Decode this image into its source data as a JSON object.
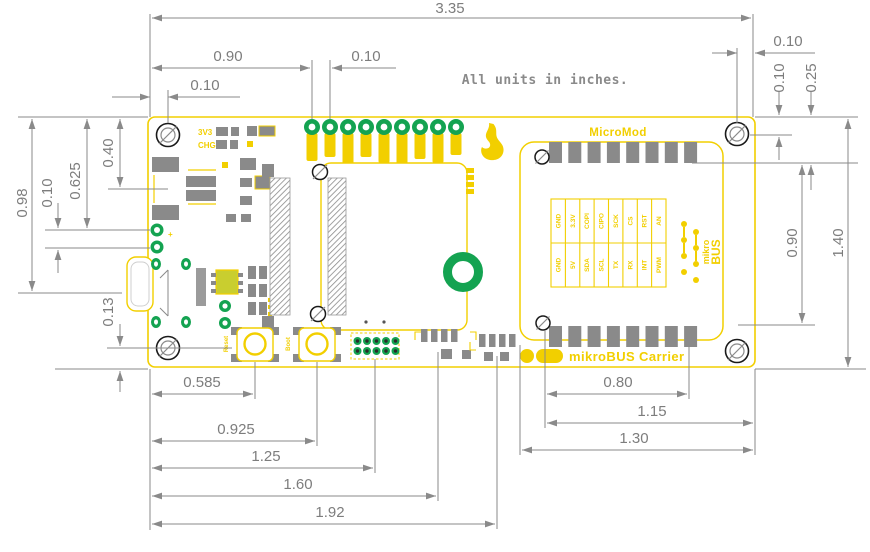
{
  "note": "All units in inches.",
  "silkscreen": {
    "micromod": "MicroMod",
    "carrier": "mikroBUS Carrier",
    "led_3v3": "3V3",
    "led_chg": "CHG",
    "btn_reset": "Reset",
    "btn_boot": "Boot",
    "logo_mikro": "mikro",
    "logo_bus": "BUS",
    "battery_plus": "+",
    "pin_top": [
      "GND",
      "3.3V",
      "COPI",
      "CIPO",
      "SCK",
      "CS",
      "RST",
      "AN"
    ],
    "pin_bottom": [
      "GND",
      "5V",
      "SDA",
      "SCL",
      "TX",
      "RX",
      "INT",
      "PWM"
    ]
  },
  "dimensions": {
    "board_width": "3.35",
    "header_offset_x": "0.90",
    "header_pitch": "0.10",
    "hole_tl_x": "0.10",
    "hole_tr_x": "0.10",
    "hole_tr_y": "0.10",
    "pads_top_y": "0.25",
    "socket_height": "0.90",
    "board_height": "1.40",
    "left_098": "0.98",
    "battery_y": "0.625",
    "battery_pitch": "0.10",
    "left_040": "0.40",
    "hole_bl_y": "0.13",
    "reset_x": "0.585",
    "boot_x": "0.925",
    "header2_x": "1.25",
    "pads1_x": "1.60",
    "pads2_x": "1.92",
    "socket_pads_width": "0.80",
    "socket_right_x": "1.15",
    "socket_width": "1.30"
  },
  "colors": {
    "silk": "#F2CF00",
    "dim_line": "#8A8A8A",
    "pad_gray": "#8A8A8A",
    "hole_green": "#14A351",
    "ic_green": "#C9CE2F",
    "ring_black": "#1A1A1A"
  }
}
